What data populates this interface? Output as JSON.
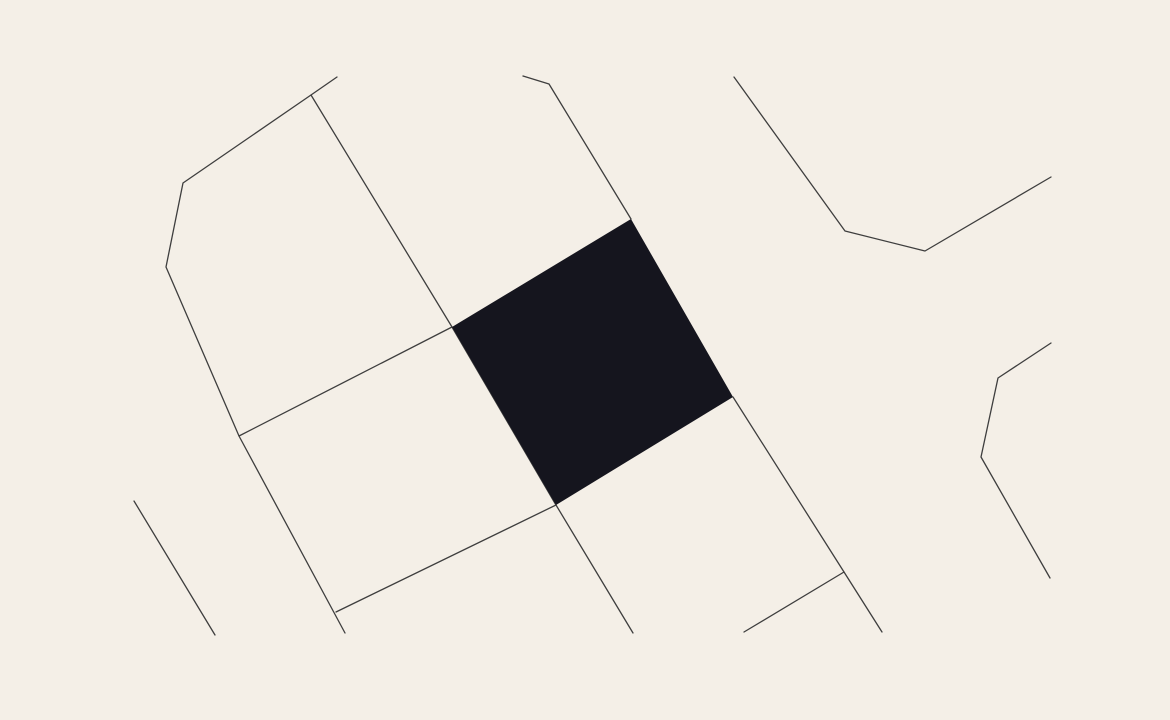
{
  "map": {
    "canvas": {
      "width": 1170,
      "height": 720
    },
    "colors": {
      "background": "#F4EFE7",
      "street": "#3E3E3E",
      "parcel_fill": "#15151E"
    },
    "street_stroke_width": 1.3,
    "streets": [
      {
        "id": "street-northwest-boundary",
        "points": [
          [
            337,
            77
          ],
          [
            311,
            95
          ],
          [
            183,
            183
          ],
          [
            166,
            267
          ],
          [
            239,
            436
          ],
          [
            345,
            633
          ]
        ]
      },
      {
        "id": "street-cross-to-parcel-left",
        "points": [
          [
            239,
            436
          ],
          [
            452,
            327
          ]
        ]
      },
      {
        "id": "street-diagonal-through-parcel",
        "points": [
          [
            311,
            95
          ],
          [
            452,
            327
          ],
          [
            556,
            505
          ],
          [
            633,
            633
          ]
        ]
      },
      {
        "id": "street-to-parcel-top",
        "points": [
          [
            523,
            76
          ],
          [
            549,
            84
          ],
          [
            631,
            219
          ]
        ]
      },
      {
        "id": "street-from-parcel-right",
        "points": [
          [
            733,
            397
          ],
          [
            844,
            572
          ],
          [
            882,
            632
          ]
        ]
      },
      {
        "id": "street-branch-southeast",
        "points": [
          [
            844,
            572
          ],
          [
            744,
            632
          ]
        ]
      },
      {
        "id": "street-cross-to-parcel-bottom",
        "points": [
          [
            336,
            612
          ],
          [
            556,
            505
          ]
        ]
      },
      {
        "id": "street-southwest-short",
        "points": [
          [
            134,
            501
          ],
          [
            215,
            635
          ]
        ]
      },
      {
        "id": "street-northeast",
        "points": [
          [
            734,
            77
          ],
          [
            845,
            231
          ],
          [
            925,
            251
          ],
          [
            1051,
            177
          ]
        ]
      },
      {
        "id": "street-east",
        "points": [
          [
            1051,
            343
          ],
          [
            998,
            378
          ],
          [
            981,
            457
          ],
          [
            1050,
            578
          ]
        ]
      }
    ],
    "parcel": {
      "id": "highlighted-parcel",
      "points": [
        [
          631,
          219
        ],
        [
          733,
          397
        ],
        [
          556,
          505
        ],
        [
          452,
          327
        ]
      ]
    }
  }
}
